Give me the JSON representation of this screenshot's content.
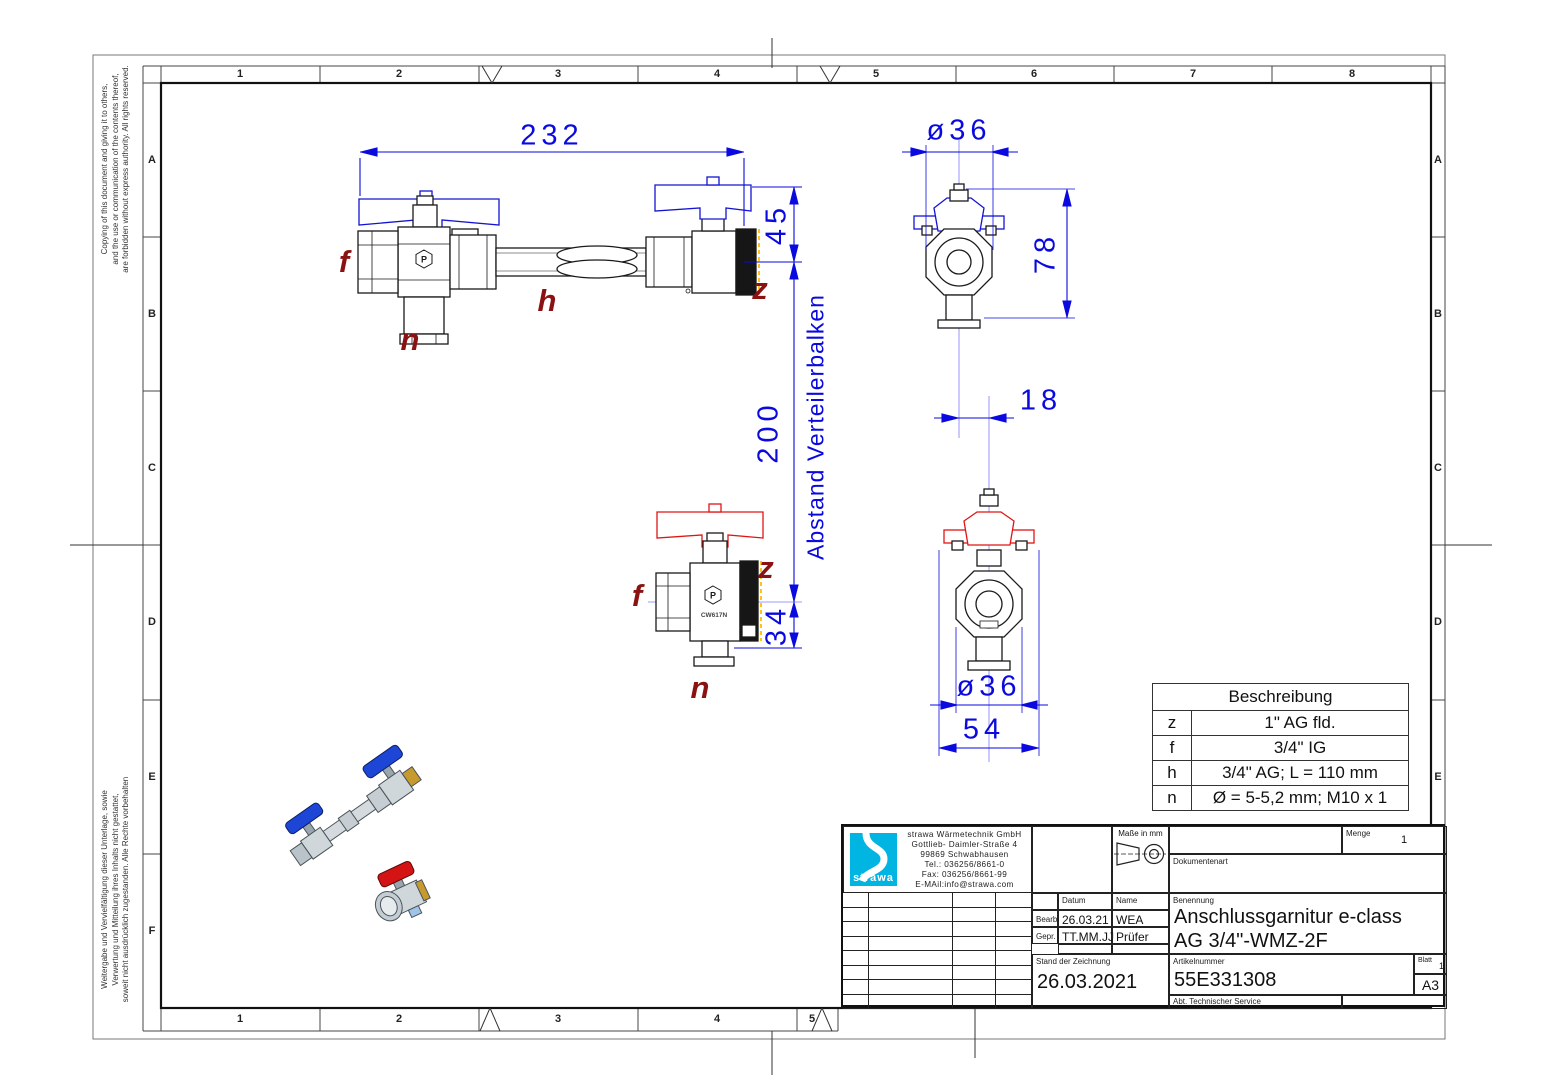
{
  "sheet": {
    "grid_cols_top": [
      "1",
      "2",
      "3",
      "4",
      "5",
      "6",
      "7",
      "8"
    ],
    "grid_cols_bottom": [
      "1",
      "2",
      "3",
      "4",
      "5"
    ],
    "grid_rows_left": [
      "A",
      "B",
      "C",
      "D",
      "E",
      "F"
    ],
    "grid_rows_right": [
      "A",
      "B",
      "C",
      "D",
      "E"
    ],
    "copyright_top": "Copying of this document and giving it to others,\nand the use or communication of the contents thereof,\nare forbidden without express authority. All rights reserved.",
    "copyright_bottom": "Weitergabe und Vervielfältigung dieser Unterlage, sowie\nVerwertung und Mitteilung ihres Inhalts nicht gestattet,\nsoweit nicht ausdrücklich zugestanden. Alle Rechte vorbehalten"
  },
  "drawing": {
    "dims": {
      "overall_length": "232",
      "valve_height_top": "45",
      "distributor_distance": "200",
      "distance_note": "Abstand Verteilerbalken",
      "valve_height_bottom": "34",
      "diameter_top": "ø36",
      "side_height": "78",
      "axis_offset": "18",
      "diameter_bottom": "ø36",
      "handle_width": "54"
    },
    "port_labels": {
      "f": "f",
      "h": "h",
      "n": "n",
      "z": "z"
    },
    "body_mark": "CW617N",
    "logo_mark": "P",
    "colors": {
      "dimension_blue": "#0a0ae0",
      "label_dark_red": "#8b1212",
      "handle_blue": "#1414d2",
      "handle_red": "#e01414",
      "thread_yellow": "#ffc21a",
      "logo_cyan": "#00b5e2"
    }
  },
  "description_table": {
    "title": "Beschreibung",
    "rows": [
      {
        "key": "z",
        "value": "1\" AG fld."
      },
      {
        "key": "f",
        "value": "3/4\" IG"
      },
      {
        "key": "h",
        "value": "3/4\" AG; L = 110 mm"
      },
      {
        "key": "n",
        "value": "Ø = 5-5,2 mm; M10 x 1"
      }
    ]
  },
  "title_block": {
    "company": {
      "logo_text": "strawa",
      "name": "strawa Wärmetechnik GmbH",
      "street": "Gottlieb- Daimler-Straße 4",
      "city": "99869 Schwabhausen",
      "tel": "Tel.: 036256/8661-0",
      "fax": "Fax: 036256/8661-99",
      "email": "E-MAil:info@strawa.com"
    },
    "units_label": "Maße in mm",
    "menge_label": "Menge",
    "menge_value": "1",
    "dokumentenart_label": "Dokumentenart",
    "datum_label": "Datum",
    "name_label": "Name",
    "bearb_label": "Bearb.",
    "bearb_datum": "26.03.21",
    "bearb_name": "WEA",
    "gepr_label": "Gepr.",
    "gepr_datum": "TT.MM.JJ",
    "gepr_name": "Prüfer",
    "benennung_label": "Benennung",
    "benennung_line1": "Anschlussgarnitur e-class",
    "benennung_line2": "AG 3/4\"-WMZ-2F",
    "stand_label": "Stand der Zeichnung",
    "stand_value": "26.03.2021",
    "artikel_label": "Artikelnummer",
    "artikel_value": "55E331308",
    "blatt_label": "Blatt",
    "blatt_value": "1",
    "format_value": "A3",
    "abt_label": "Abt. Technischer Service"
  }
}
